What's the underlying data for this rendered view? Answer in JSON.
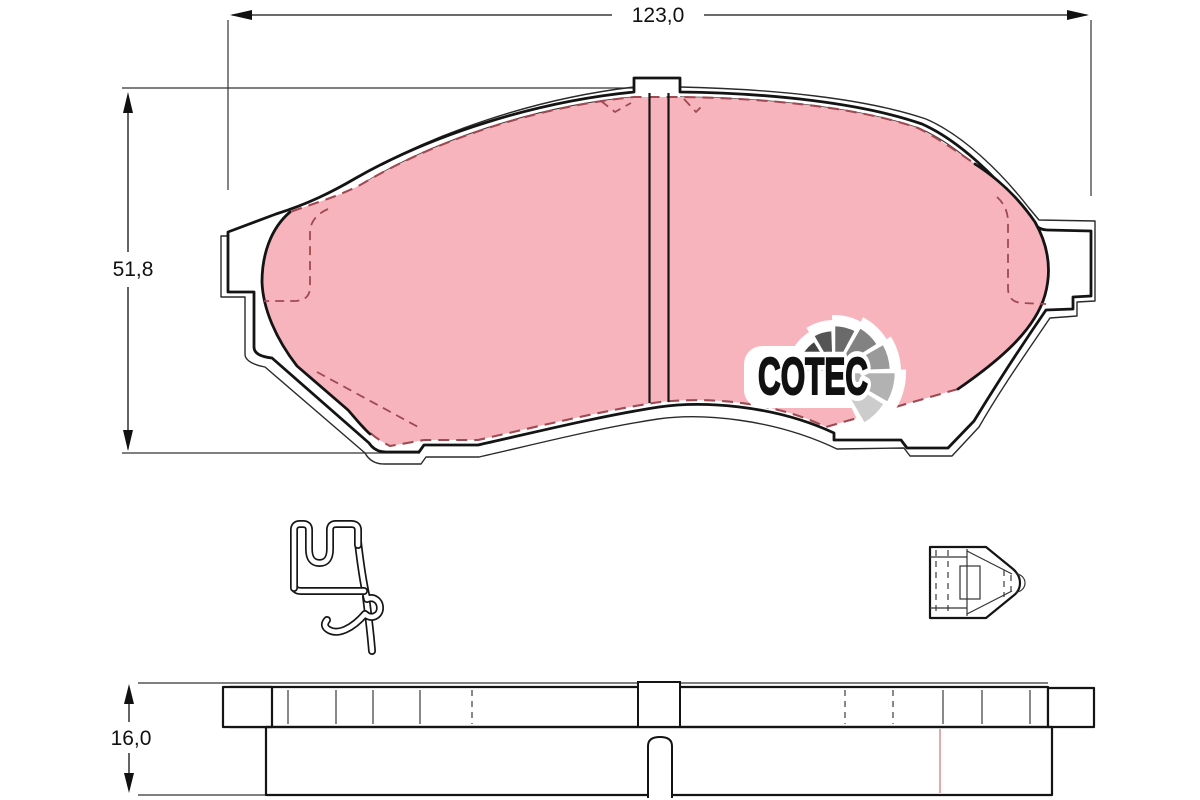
{
  "drawing": {
    "dims": {
      "width_label": "123,0",
      "height_label": "51,8",
      "thickness_label": "16,0"
    },
    "logo": {
      "text": "COTEC",
      "fan_colors": [
        "#1c1c1c",
        "#424242",
        "#555555",
        "#6a6a6a",
        "#828282",
        "#9a9a9a",
        "#b2b2b2",
        "#cccccc"
      ]
    },
    "colors": {
      "friction": "#f8b4bc",
      "friction_edge": "#9e4a52",
      "outline": "#141414",
      "groove_joint": "#e0939b"
    }
  }
}
